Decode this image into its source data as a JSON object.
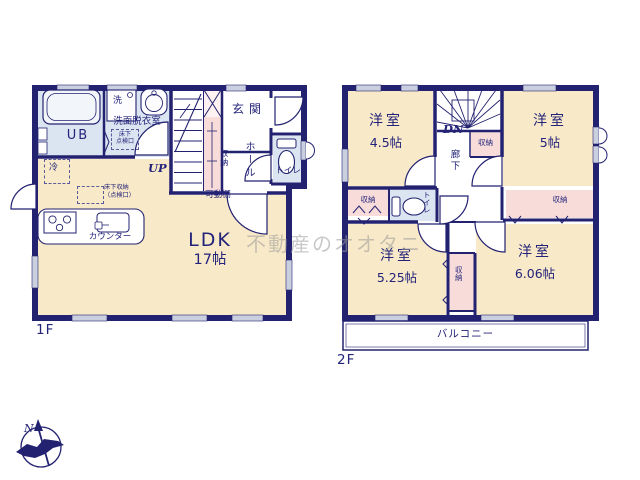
{
  "watermark_text": "不動産のオオタニ",
  "compass": {
    "north_label": "N"
  },
  "colors": {
    "wall_navy": "#232270",
    "floor_cream": "#f8e9c8",
    "wet_area_blue": "#dbe5f1",
    "closet_pink": "#f7dcda",
    "window_gray": "#c9cfdf",
    "label_navy": "#23237a"
  },
  "floor1": {
    "floor_label": "1F",
    "unit_bath_label": "UB",
    "washer_label": "洗",
    "washroom_label": "洗面脱衣室",
    "underfloor_hatch_line1": "床下",
    "underfloor_hatch_line2": "点検口",
    "stairs_up_label": "UP",
    "movable_shelf_label": "可動棚",
    "entrance_label": "玄関",
    "storage_label": "収納",
    "hall_label": "ホール",
    "toilet_label": "トイレ",
    "fridge_label": "冷",
    "underfloor_storage_line1": "床下収納",
    "underfloor_storage_line2": "（点検口）",
    "counter_label": "カウンター",
    "ldk_label": "LDK",
    "ldk_size": "17帖"
  },
  "floor2": {
    "floor_label": "2F",
    "stairs_down_label": "DN",
    "corridor_label": "廊下",
    "toilet_label": "トイレ",
    "balcony_label": "バルコニー",
    "room_45": {
      "name": "洋室",
      "size": "4.5帖"
    },
    "room_5": {
      "name": "洋室",
      "size": "5帖"
    },
    "room_525": {
      "name": "洋室",
      "size": "5.25帖"
    },
    "room_606": {
      "name": "洋室",
      "size": "6.06帖"
    },
    "storage_by_stairs_label": "収納",
    "storage_left_label": "収納",
    "storage_right_label": "収納",
    "storage_center_label": "収納"
  }
}
